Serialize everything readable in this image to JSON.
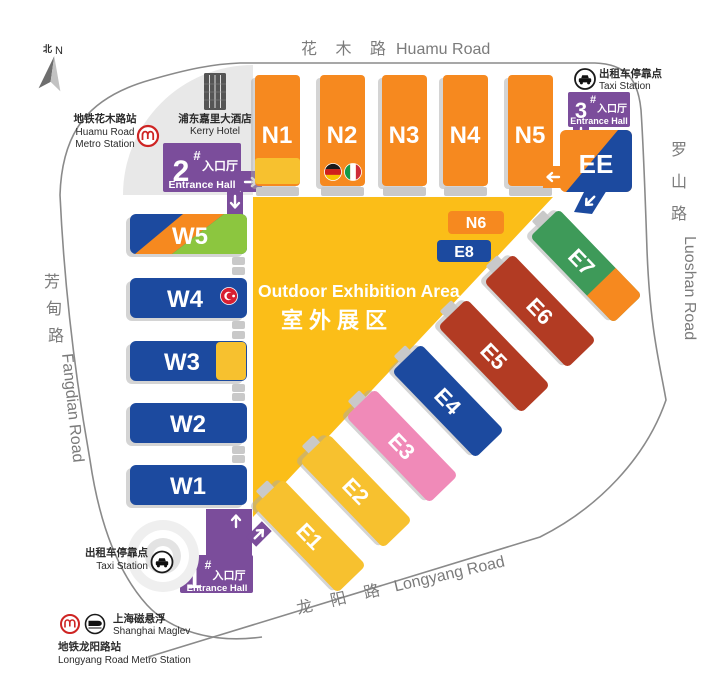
{
  "map": {
    "compass": {
      "bei": "北",
      "n": "N"
    },
    "roads": {
      "huamu_zh": "花 木 路",
      "huamu_en": "Huamu Road",
      "luoshan_zh": [
        "罗",
        "山",
        "路"
      ],
      "luoshan_en": "Luoshan Road",
      "fangdian_zh": [
        "芳",
        "甸",
        "路"
      ],
      "fangdian_en": "Fangdian Road",
      "longyang_zh": "龙 阳 路",
      "longyang_en": "Longyang Road"
    },
    "landmarks": {
      "huamu_metro_zh": "地铁花木路站",
      "huamu_metro_en1": "Huamu Road",
      "huamu_metro_en2": "Metro Station",
      "kerry_zh": "浦东嘉里大酒店",
      "kerry_en": "Kerry Hotel",
      "taxi_zh": "出租车停靠点",
      "taxi_en": "Taxi Station",
      "maglev_zh": "上海磁悬浮",
      "maglev_en": "Shanghai Maglev",
      "longyang_metro_zh": "地铁龙阳路站",
      "longyang_metro_en": "Longyang Road Metro Station"
    },
    "entrances": {
      "one": {
        "digit": "1",
        "hash": "#",
        "zh": "入口厅",
        "en": "Entrance Hall"
      },
      "two": {
        "digit": "2",
        "hash": "#",
        "zh": "入口厅",
        "en": "Entrance Hall"
      },
      "three": {
        "digit": "3",
        "hash": "#",
        "zh": "入口厅",
        "en": "Entrance Hall"
      }
    },
    "outdoor": {
      "en": "Outdoor Exhibition Area",
      "zh": "室外展区"
    },
    "halls": {
      "north": [
        "N1",
        "N2",
        "N3",
        "N4",
        "N5"
      ],
      "west": [
        "W1",
        "W2",
        "W3",
        "W4",
        "W5"
      ],
      "east": [
        "E1",
        "E2",
        "E3",
        "E4",
        "E5",
        "E6",
        "E7"
      ],
      "ee": "EE",
      "n6": "N6",
      "e8": "E8"
    },
    "colors": {
      "orange": "#F6891F",
      "yellow": "#FBBE18",
      "gold": "#F7C12F",
      "blue": "#1C4A9F",
      "purple": "#7B4D9B",
      "pink": "#F08AB8",
      "brick": "#B23B23",
      "green": "#3E9A59",
      "lime": "#8CC63F",
      "connector_gray": "#C9C9C9",
      "road_gray": "#8A8A8A",
      "metro_red": "#CE2423"
    }
  }
}
